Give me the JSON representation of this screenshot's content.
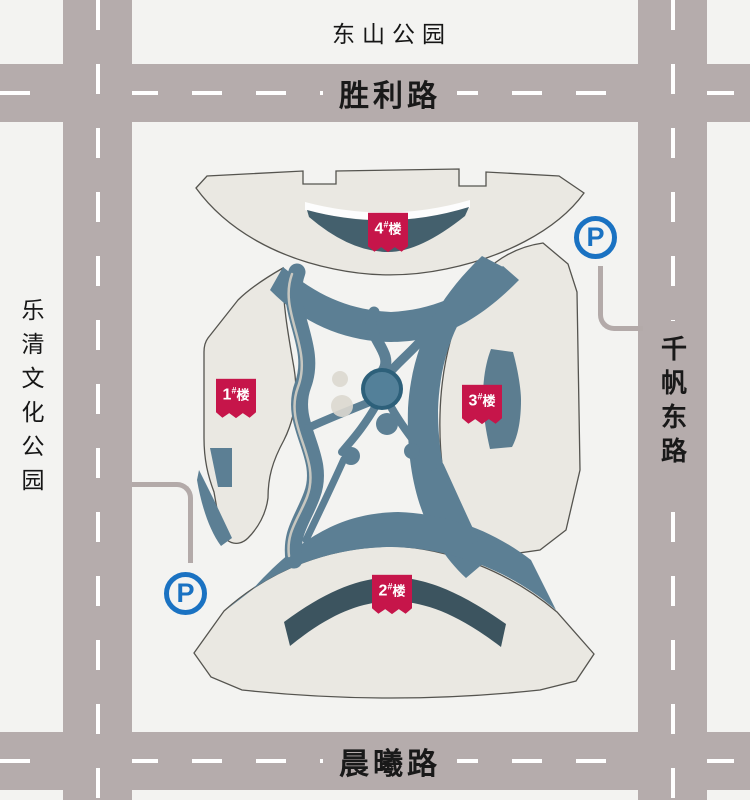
{
  "labels": {
    "top_park": "东山公园",
    "left_park": "乐清文化公园"
  },
  "roads": {
    "top": "胜利路",
    "bottom": "晨曦路",
    "right": "千帆东路"
  },
  "buildings": [
    {
      "id": "1",
      "num": "1",
      "hash": "#",
      "suffix": "楼"
    },
    {
      "id": "2",
      "num": "2",
      "hash": "#",
      "suffix": "楼"
    },
    {
      "id": "3",
      "num": "3",
      "hash": "#",
      "suffix": "楼"
    },
    {
      "id": "4",
      "num": "4",
      "hash": "#",
      "suffix": "楼"
    }
  ],
  "parking": {
    "symbol": "P",
    "color": "#1a72c2"
  },
  "colors": {
    "background": "#f3f3f1",
    "road": "#b5acac",
    "road_dash": "#ffffff",
    "building_fill": "#eae8e2",
    "building_outline": "#55544f",
    "landscape_path": "#5c7f94",
    "dark_building_band": "#44606d",
    "dark_building_band_2": "#3c545f",
    "building3_core": "#5c7d90",
    "pond_fill": "#538099",
    "pond_stroke": "#2d607a",
    "flag_red": "#c6154a",
    "connector_gray": "#b3aaa9"
  }
}
